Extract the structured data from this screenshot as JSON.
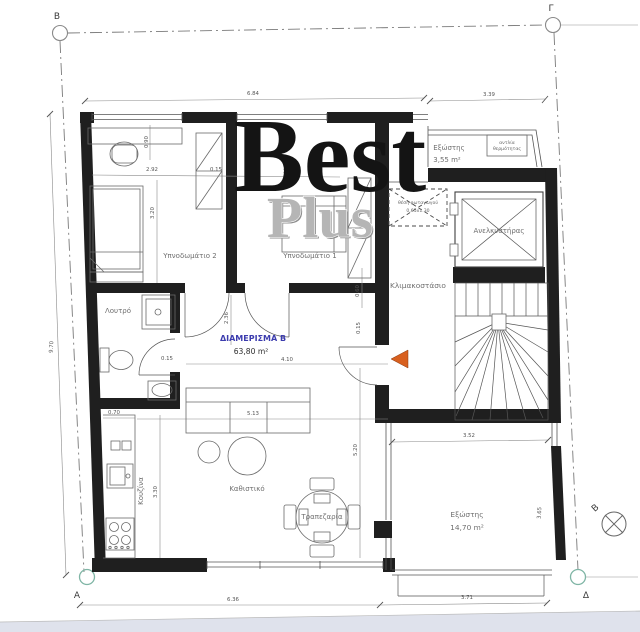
{
  "watermark": {
    "primary": "Best",
    "secondary": "Plus"
  },
  "apartment": {
    "name": "ΔΙΑΜΕΡΙΣΜΑ Β",
    "area": "63,80 m²"
  },
  "rooms": {
    "bedroom2": "Υπνοδωμάτιο 2",
    "bedroom1": "Υπνοδωμάτιο 1",
    "bathroom": "Λουτρό",
    "kitchen": "Κουζίνα",
    "living_room": "Καθιστικό",
    "dining": "Τραπεζαρία",
    "stairwell": "Κλιμακοστάσιο",
    "elevator": "Ανελκυστήρας",
    "balcony_top": {
      "name": "Εξώστης",
      "area": "3,55 m²"
    },
    "balcony_bottom": {
      "name": "Εξώστης",
      "area": "14,70 m²"
    }
  },
  "annotations": {
    "heat_pump_line1": "αντλία",
    "heat_pump_line2": "θερμότητας",
    "skylight_line1": "θέση φωταγωγού",
    "skylight_line2": "0.65x1.30"
  },
  "grid_markers": {
    "top_left": "Β",
    "top_right": "Γ",
    "bottom_left": "Α",
    "bottom_right": "Δ",
    "section": "Β"
  },
  "dimensions": {
    "top_left": "6.84",
    "top_right": "3.39",
    "bottom_left": "6.36",
    "bottom_right": "3.71",
    "left_height": "9.70",
    "bedroom2_width": "2.92",
    "partition": "0.15",
    "bedroom1_width": "3.05",
    "bedroom2_depth": "3.20",
    "desk_offset": "0.90",
    "hall_depth": "2.36",
    "hall_gap": "0.15",
    "kitchen_offset": "0.70",
    "kitchen_depth": "3.30",
    "living_width": "4.10",
    "sofa_span": "5.13",
    "living_depth": "5.20",
    "wardrobe": "0.60",
    "entry_gap": "0.15",
    "balcony_width": "3.52",
    "balcony_depth": "3.65"
  },
  "colors": {
    "wall": "#1f1f1f",
    "line": "#555555",
    "label": "#6f6f6f",
    "accent_blue": "#3c3cae",
    "arrow_orange": "#d8601f",
    "marker_teal": "#7fb5a5",
    "watermark_gray": "#adadad",
    "footer_tint": "#dfe2ec"
  }
}
